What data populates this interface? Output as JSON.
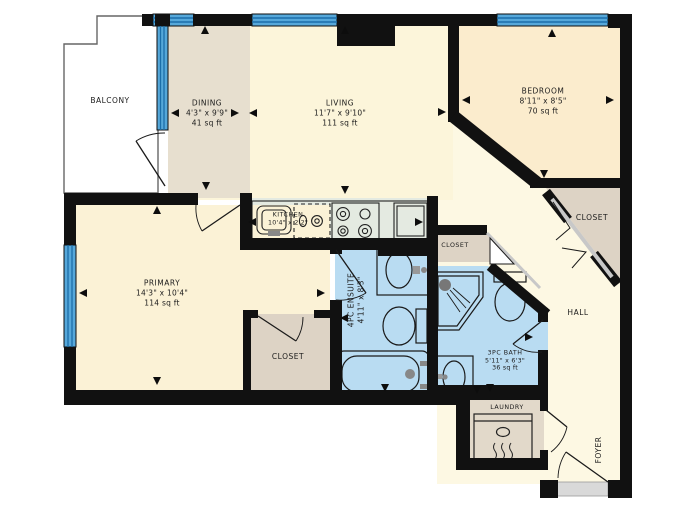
{
  "title": "Condo Unit Floor Plan",
  "rooms": {
    "balcony": {
      "name": "BALCONY"
    },
    "dining": {
      "name": "DINING",
      "dim": "4'3\" x 9'9\"",
      "area": "41 sq ft"
    },
    "living": {
      "name": "LIVING",
      "dim": "11'7\" x 9'10\"",
      "area": "111 sq ft"
    },
    "bedroom": {
      "name": "BEDROOM",
      "dim": "8'11\" x 8'5\"",
      "area": "70 sq ft"
    },
    "kitchen": {
      "name": "KITCHEN",
      "dim": "10'4\" x 2'2\""
    },
    "primary": {
      "name": "PRIMARY",
      "dim": "14'3\" x 10'4\"",
      "area": "114 sq ft"
    },
    "primary_closet": {
      "name": "CLOSET"
    },
    "ensuite": {
      "name": "4PC ENSUITE",
      "dim": "4'11\" x 8'3\""
    },
    "bath_closet": {
      "name": "CLOSET"
    },
    "bath": {
      "name": "3PC BATH",
      "dim": "5'11\" x 6'3\"",
      "area": "36 sq ft"
    },
    "bedroom_closet": {
      "name": "CLOSET"
    },
    "hall": {
      "name": "HALL"
    },
    "laundry": {
      "name": "LAUNDRY"
    },
    "foyer": {
      "name": "FOYER"
    }
  },
  "colors": {
    "wall": "#111111",
    "window": "#56a8da",
    "window_stripe": "#1b6ea9",
    "living_fill": "#fcf5da",
    "bedroom_fill": "#fbeccd",
    "primary_fill": "#fbf2d6",
    "hall_fill": "#fdf8e3",
    "dining_fill": "#e7dfcf",
    "closet_fill": "#ddd3c5",
    "bath_fill": "#b9dcf2",
    "kitchen_fill": "#e4eae1",
    "balcony_fill": "#ffffff"
  }
}
